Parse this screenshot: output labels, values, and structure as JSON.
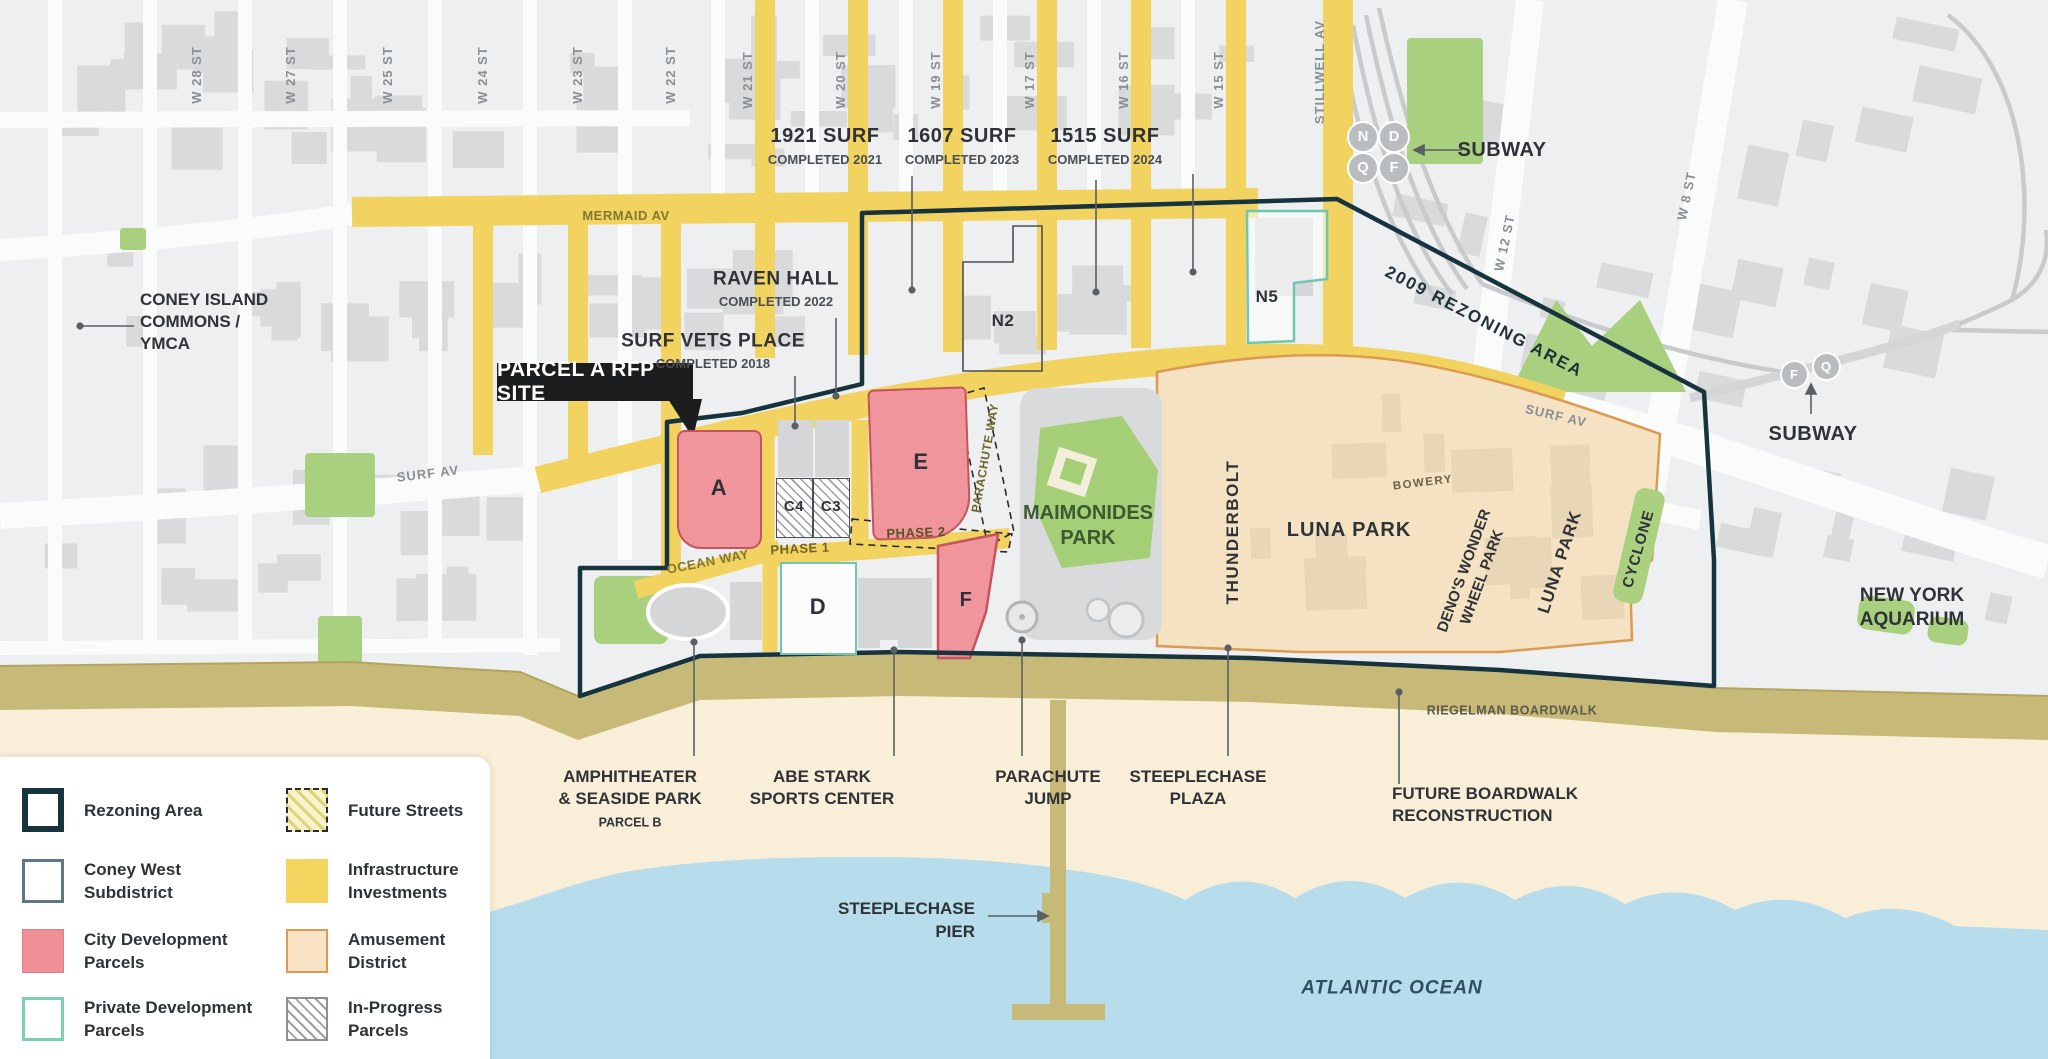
{
  "streets": {
    "cross": [
      {
        "id": "w28",
        "label": "W 28 ST"
      },
      {
        "id": "w27",
        "label": "W 27 ST"
      },
      {
        "id": "w25",
        "label": "W 25 ST"
      },
      {
        "id": "w24",
        "label": "W 24 ST"
      },
      {
        "id": "w23",
        "label": "W 23 ST"
      },
      {
        "id": "w22",
        "label": "W 22 ST"
      },
      {
        "id": "w21",
        "label": "W 21 ST"
      },
      {
        "id": "w20",
        "label": "W 20 ST"
      },
      {
        "id": "w19",
        "label": "W 19 ST"
      },
      {
        "id": "w17",
        "label": "W 17 ST"
      },
      {
        "id": "w16",
        "label": "W 16 ST"
      },
      {
        "id": "w15",
        "label": "W 15 ST"
      },
      {
        "id": "stillwell",
        "label": "STILLWELL AV"
      },
      {
        "id": "w12",
        "label": "W 12 ST"
      },
      {
        "id": "w8",
        "label": "W 8 ST"
      }
    ],
    "avenues": {
      "mermaid": "MERMAID AV",
      "surf_west": "SURF AV",
      "surf_east": "SURF AV",
      "ocean_way": "OCEAN WAY",
      "bowery": "BOWERY",
      "riegelman": "RIEGELMAN BOARDWALK"
    },
    "phases": {
      "phase1": "PHASE 1",
      "phase2": "PHASE 2",
      "parachute_way": "PARACHUTE WAY"
    }
  },
  "developments": {
    "surf1921": {
      "name": "1921 SURF",
      "status": "COMPLETED 2021"
    },
    "surf1607": {
      "name": "1607 SURF",
      "status": "COMPLETED 2023"
    },
    "surf1515": {
      "name": "1515 SURF",
      "status": "COMPLETED 2024"
    },
    "raven_hall": {
      "name": "RAVEN HALL",
      "status": "COMPLETED 2022"
    },
    "surf_vets": {
      "name": "SURF VETS PLACE",
      "status": "COMPLETED 2018"
    }
  },
  "callouts": {
    "parcel_a_badge": "PARCEL A RFP SITE",
    "commons": [
      "CONEY ISLAND",
      "COMMONS /",
      "YMCA"
    ],
    "subway_left": "SUBWAY",
    "subway_right": "SUBWAY",
    "rezoning_2009": "2009 REZONING AREA",
    "maimonides": [
      "MAIMONIDES",
      "PARK"
    ],
    "ny_aquarium": [
      "NEW YORK",
      "AQUARIUM"
    ],
    "atlantic_ocean": "ATLANTIC OCEAN"
  },
  "amusement": {
    "thunderbolt": "THUNDERBOLT",
    "luna_park": "LUNA PARK",
    "denos": [
      "DENO'S WONDER",
      "WHEEL PARK"
    ],
    "luna_park_2": "LUNA PARK",
    "cyclone": "CYCLONE"
  },
  "waterfront": {
    "amphitheater": [
      "AMPHITHEATER",
      "& SEASIDE PARK"
    ],
    "parcel_b": "PARCEL B",
    "abe_stark": [
      "ABE STARK",
      "SPORTS CENTER"
    ],
    "parachute_jump": [
      "PARACHUTE",
      "JUMP"
    ],
    "steeplechase_plaza": [
      "STEEPLECHASE",
      "PLAZA"
    ],
    "future_boardwalk": [
      "FUTURE BOARDWALK",
      "RECONSTRUCTION"
    ],
    "steeplechase_pier": [
      "STEEPLECHASE",
      "PIER"
    ]
  },
  "parcels": [
    {
      "id": "a",
      "label": "A",
      "type": "city"
    },
    {
      "id": "c4",
      "label": "C4",
      "type": "inprogress"
    },
    {
      "id": "c3",
      "label": "C3",
      "type": "inprogress"
    },
    {
      "id": "e",
      "label": "E",
      "type": "city"
    },
    {
      "id": "d",
      "label": "D",
      "type": "private"
    },
    {
      "id": "f",
      "label": "F",
      "type": "city"
    },
    {
      "id": "n2",
      "label": "N2",
      "type": "inprogress"
    },
    {
      "id": "n5",
      "label": "N5",
      "type": "private"
    }
  ],
  "subway_bullets": {
    "left": [
      "N",
      "D",
      "Q",
      "F"
    ],
    "right": [
      "F",
      "Q"
    ]
  },
  "legend": [
    {
      "id": "rezoning",
      "swatch": "sw-rezoning",
      "lines": [
        "Rezoning Area"
      ]
    },
    {
      "id": "coney-west",
      "swatch": "sw-coney",
      "lines": [
        "Coney West",
        "Subdistrict"
      ]
    },
    {
      "id": "city-dev",
      "swatch": "sw-city",
      "lines": [
        "City Development",
        "Parcels"
      ]
    },
    {
      "id": "private-dev",
      "swatch": "sw-private",
      "lines": [
        "Private Development",
        "Parcels"
      ]
    },
    {
      "id": "future-streets",
      "swatch": "sw-future",
      "lines": [
        "Future Streets"
      ]
    },
    {
      "id": "infrastructure",
      "swatch": "sw-infra",
      "lines": [
        "Infrastructure",
        "Investments"
      ]
    },
    {
      "id": "amusement",
      "swatch": "sw-amuse",
      "lines": [
        "Amusement",
        "District"
      ]
    },
    {
      "id": "in-progress",
      "swatch": "sw-progress",
      "lines": [
        "In-Progress",
        "Parcels"
      ]
    }
  ],
  "colors": {
    "background": "#eeeff0",
    "street": "#fafbfb",
    "building": "#d9dadb",
    "tan_building": "#e8d6b6",
    "infrastructure_yellow": "#f2d360",
    "city_parcel_pink": "#f0959b",
    "parcel_pink_border": "#c4545e",
    "amusement_tan": "#f5e2c2",
    "amusement_border": "#dc9b51",
    "private_teal": "#6fc7b2",
    "rezoning_navy": "#16333e",
    "park_green": "#a9d07f",
    "boardwalk_olive": "#c7ba78",
    "beach_sand": "#f9efd9",
    "ocean_blue": "#b7ddec",
    "street_label_gray": "#8a8f93",
    "olive_text": "#837733",
    "dark_text": "#2f3337"
  }
}
